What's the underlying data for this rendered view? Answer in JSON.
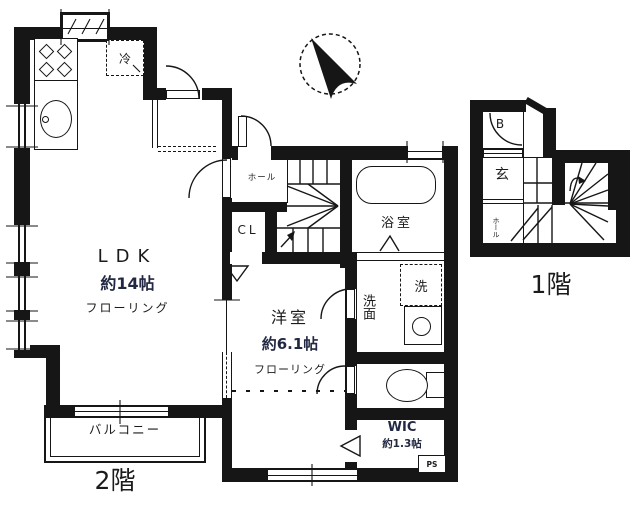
{
  "floor2": {
    "label": "2階",
    "rooms": {
      "ldk": {
        "name": "LDK",
        "size": "約14帖",
        "floor_type": "フローリング"
      },
      "youshitsu": {
        "name": "洋室",
        "size": "約6.1帖",
        "floor_type": "フローリング"
      },
      "bath": {
        "name": "浴室"
      },
      "senmen": {
        "name": "洗面"
      },
      "wic": {
        "name": "WIC",
        "size": "約1.3帖"
      },
      "cl": {
        "name": "CL"
      },
      "hall": {
        "name": "ホール"
      },
      "balcony": {
        "name": "バルコニー"
      },
      "fridge": {
        "name": "冷"
      },
      "washer": {
        "name": "洗"
      },
      "ps": {
        "name": "PS"
      }
    }
  },
  "floor1": {
    "label": "1階",
    "rooms": {
      "b": {
        "name": "B"
      },
      "genkan": {
        "name": "玄"
      },
      "hall": {
        "name": "ホール"
      }
    }
  },
  "colors": {
    "line": "#161616",
    "size_text": "#232842"
  }
}
